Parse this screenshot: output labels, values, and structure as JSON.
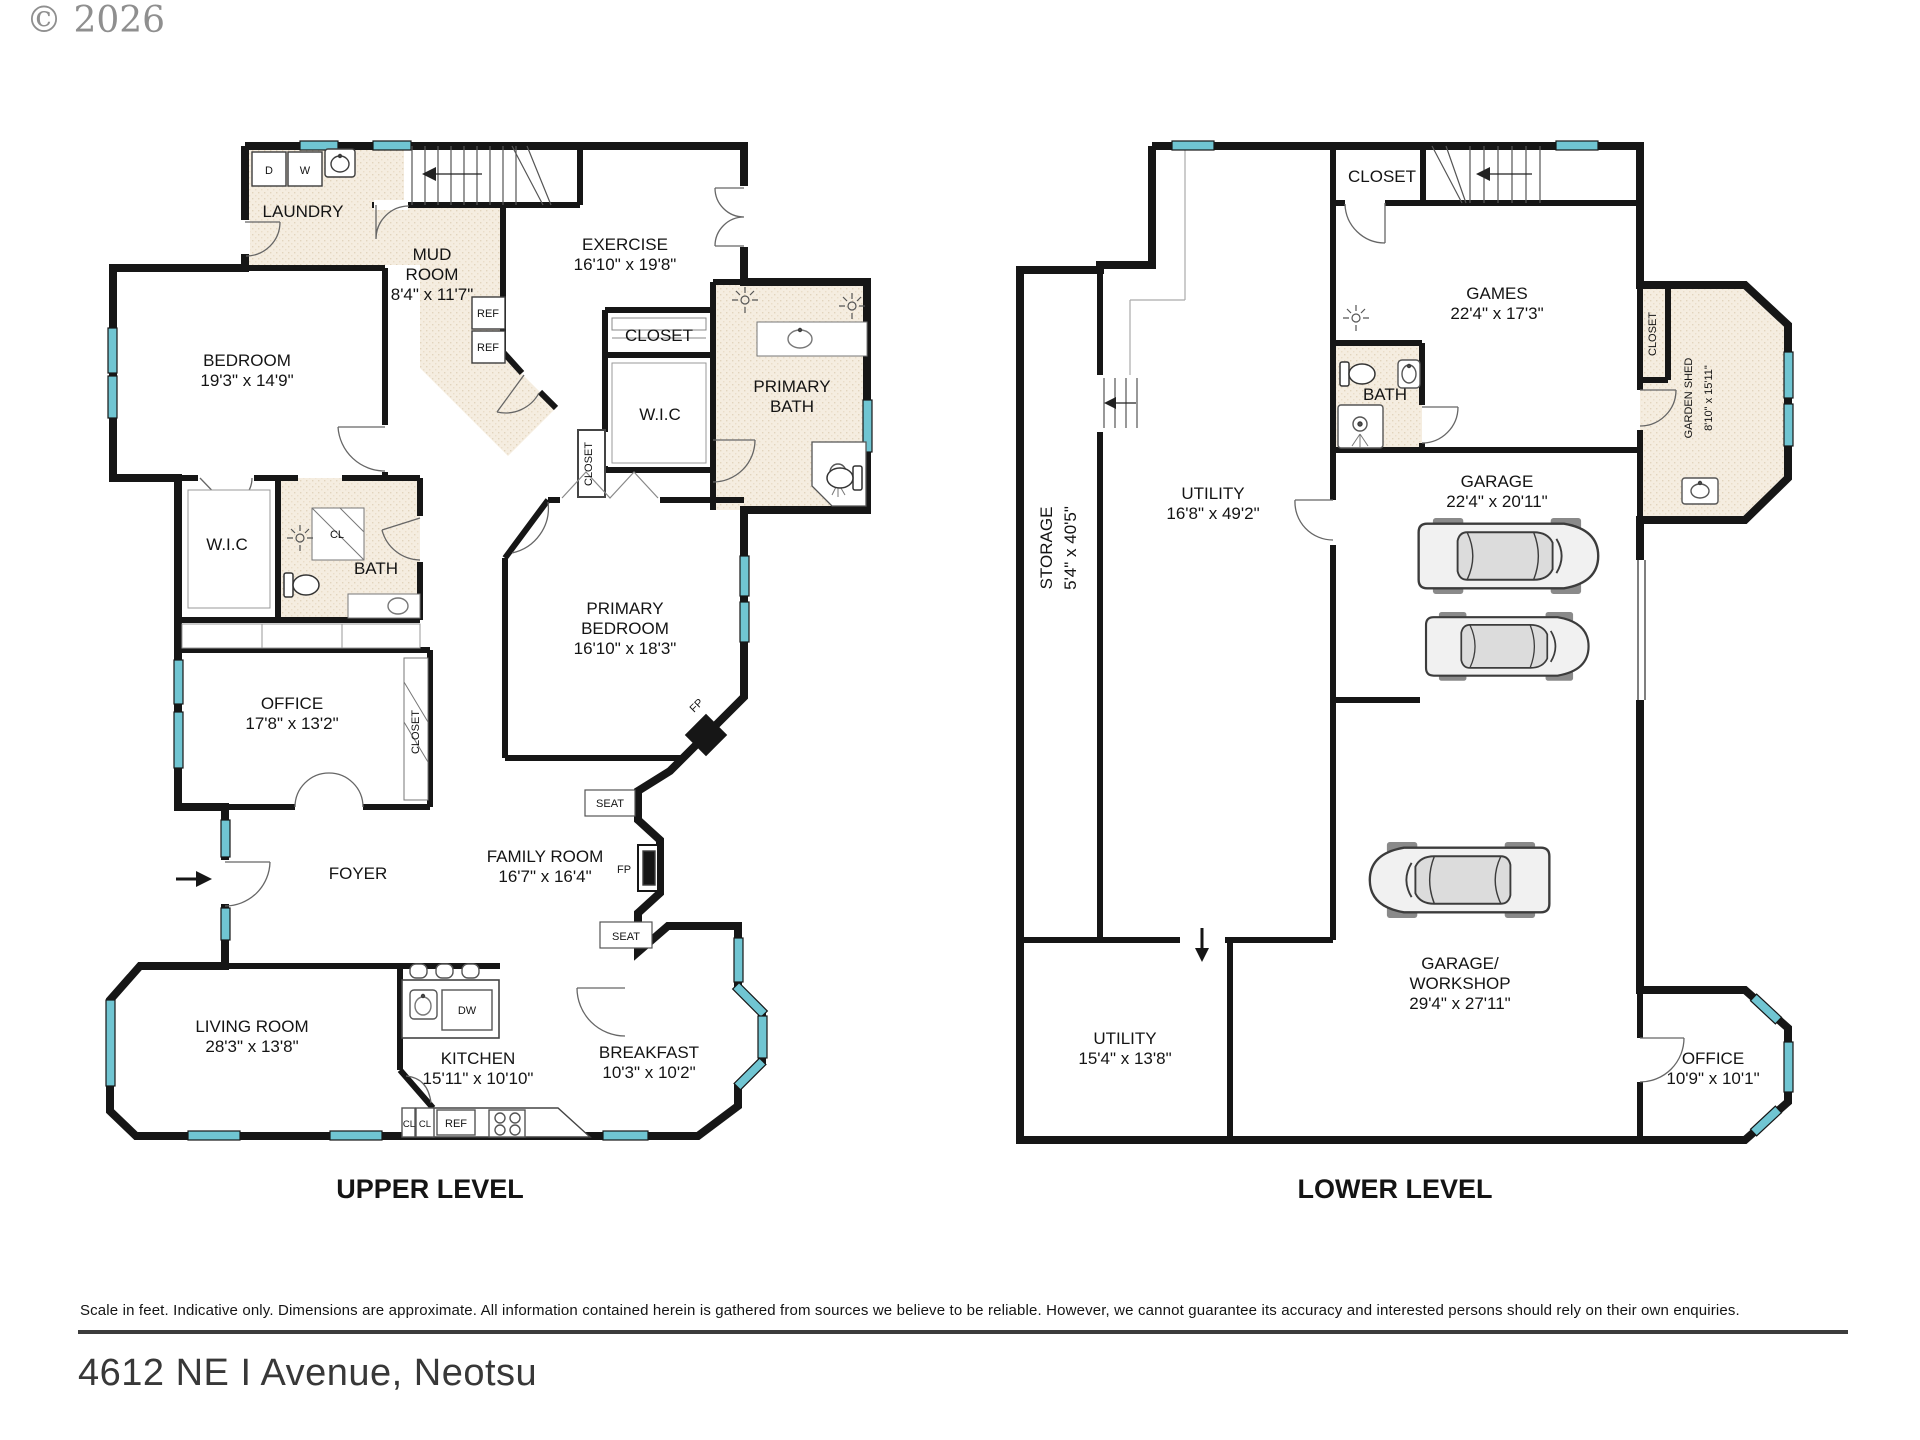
{
  "meta": {
    "copyright": "© 2026"
  },
  "footer": {
    "disclaimer": "Scale in feet. Indicative only. Dimensions are approximate. All information contained herein is gathered from sources we believe to be reliable. However, we cannot guarantee its accuracy and interested persons should rely on their own enquiries.",
    "address": "4612 NE I Avenue, Neotsu"
  },
  "colors": {
    "wall": "#161616",
    "window_glass": "#70c5d2",
    "floor_tile": "#f5ede0",
    "detail_line": "#555555"
  },
  "upper": {
    "title": "UPPER LEVEL",
    "labels": {
      "laundry": "LAUNDRY",
      "dryer": "D",
      "washer": "W",
      "mud_room": [
        "MUD",
        "ROOM",
        "8'4\" x 11'7\""
      ],
      "exercise": [
        "EXERCISE",
        "16'10\" x 19'8\""
      ],
      "ref1": "REF",
      "ref2": "REF",
      "bedroom": [
        "BEDROOM",
        "19'3\" x 14'9\""
      ],
      "closet_mid": "CLOSET",
      "wic_mid": "W.I.C",
      "primary_bath": [
        "PRIMARY",
        "BATH"
      ],
      "wic_left": "W.I.C",
      "cl_bath": "CL",
      "bath": "BATH",
      "closet_corridor": "CLOSET",
      "office": [
        "OFFICE",
        "17'8\" x 13'2\""
      ],
      "closet_office": "CLOSET",
      "primary_bedroom": [
        "PRIMARY",
        "BEDROOM",
        "16'10\" x 18'3\""
      ],
      "fp_corner": "FP",
      "seat_top": "SEAT",
      "fp_side": "FP",
      "seat_bottom": "SEAT",
      "family_room": [
        "FAMILY ROOM",
        "16'7\" x 16'4\""
      ],
      "foyer": "FOYER",
      "living_room": [
        "LIVING ROOM",
        "28'3\" x 13'8\""
      ],
      "kitchen": [
        "KITCHEN",
        "15'11\" x 10'10\""
      ],
      "dw": "DW",
      "cl1": "CL",
      "cl2": "CL",
      "ref_kitchen": "REF",
      "breakfast": [
        "BREAKFAST",
        "10'3\" x 10'2\""
      ]
    }
  },
  "lower": {
    "title": "LOWER LEVEL",
    "labels": {
      "closet_top": "CLOSET",
      "games": [
        "GAMES",
        "22'4\" x 17'3\""
      ],
      "bath": "BATH",
      "closet_shed": "CLOSET",
      "garden_shed": [
        "GARDEN SHED",
        "8'10\" x 15'11\""
      ],
      "storage": [
        "STORAGE",
        "5'4\" x 40'5\""
      ],
      "utility_main": [
        "UTILITY",
        "16'8\" x 49'2\""
      ],
      "garage": [
        "GARAGE",
        "22'4\" x 20'11\""
      ],
      "garage_workshop": [
        "GARAGE/",
        "WORKSHOP",
        "29'4\" x 27'11\""
      ],
      "utility_lower": [
        "UTILITY",
        "15'4\" x 13'8\""
      ],
      "office": [
        "OFFICE",
        "10'9\" x 10'1\""
      ]
    }
  }
}
